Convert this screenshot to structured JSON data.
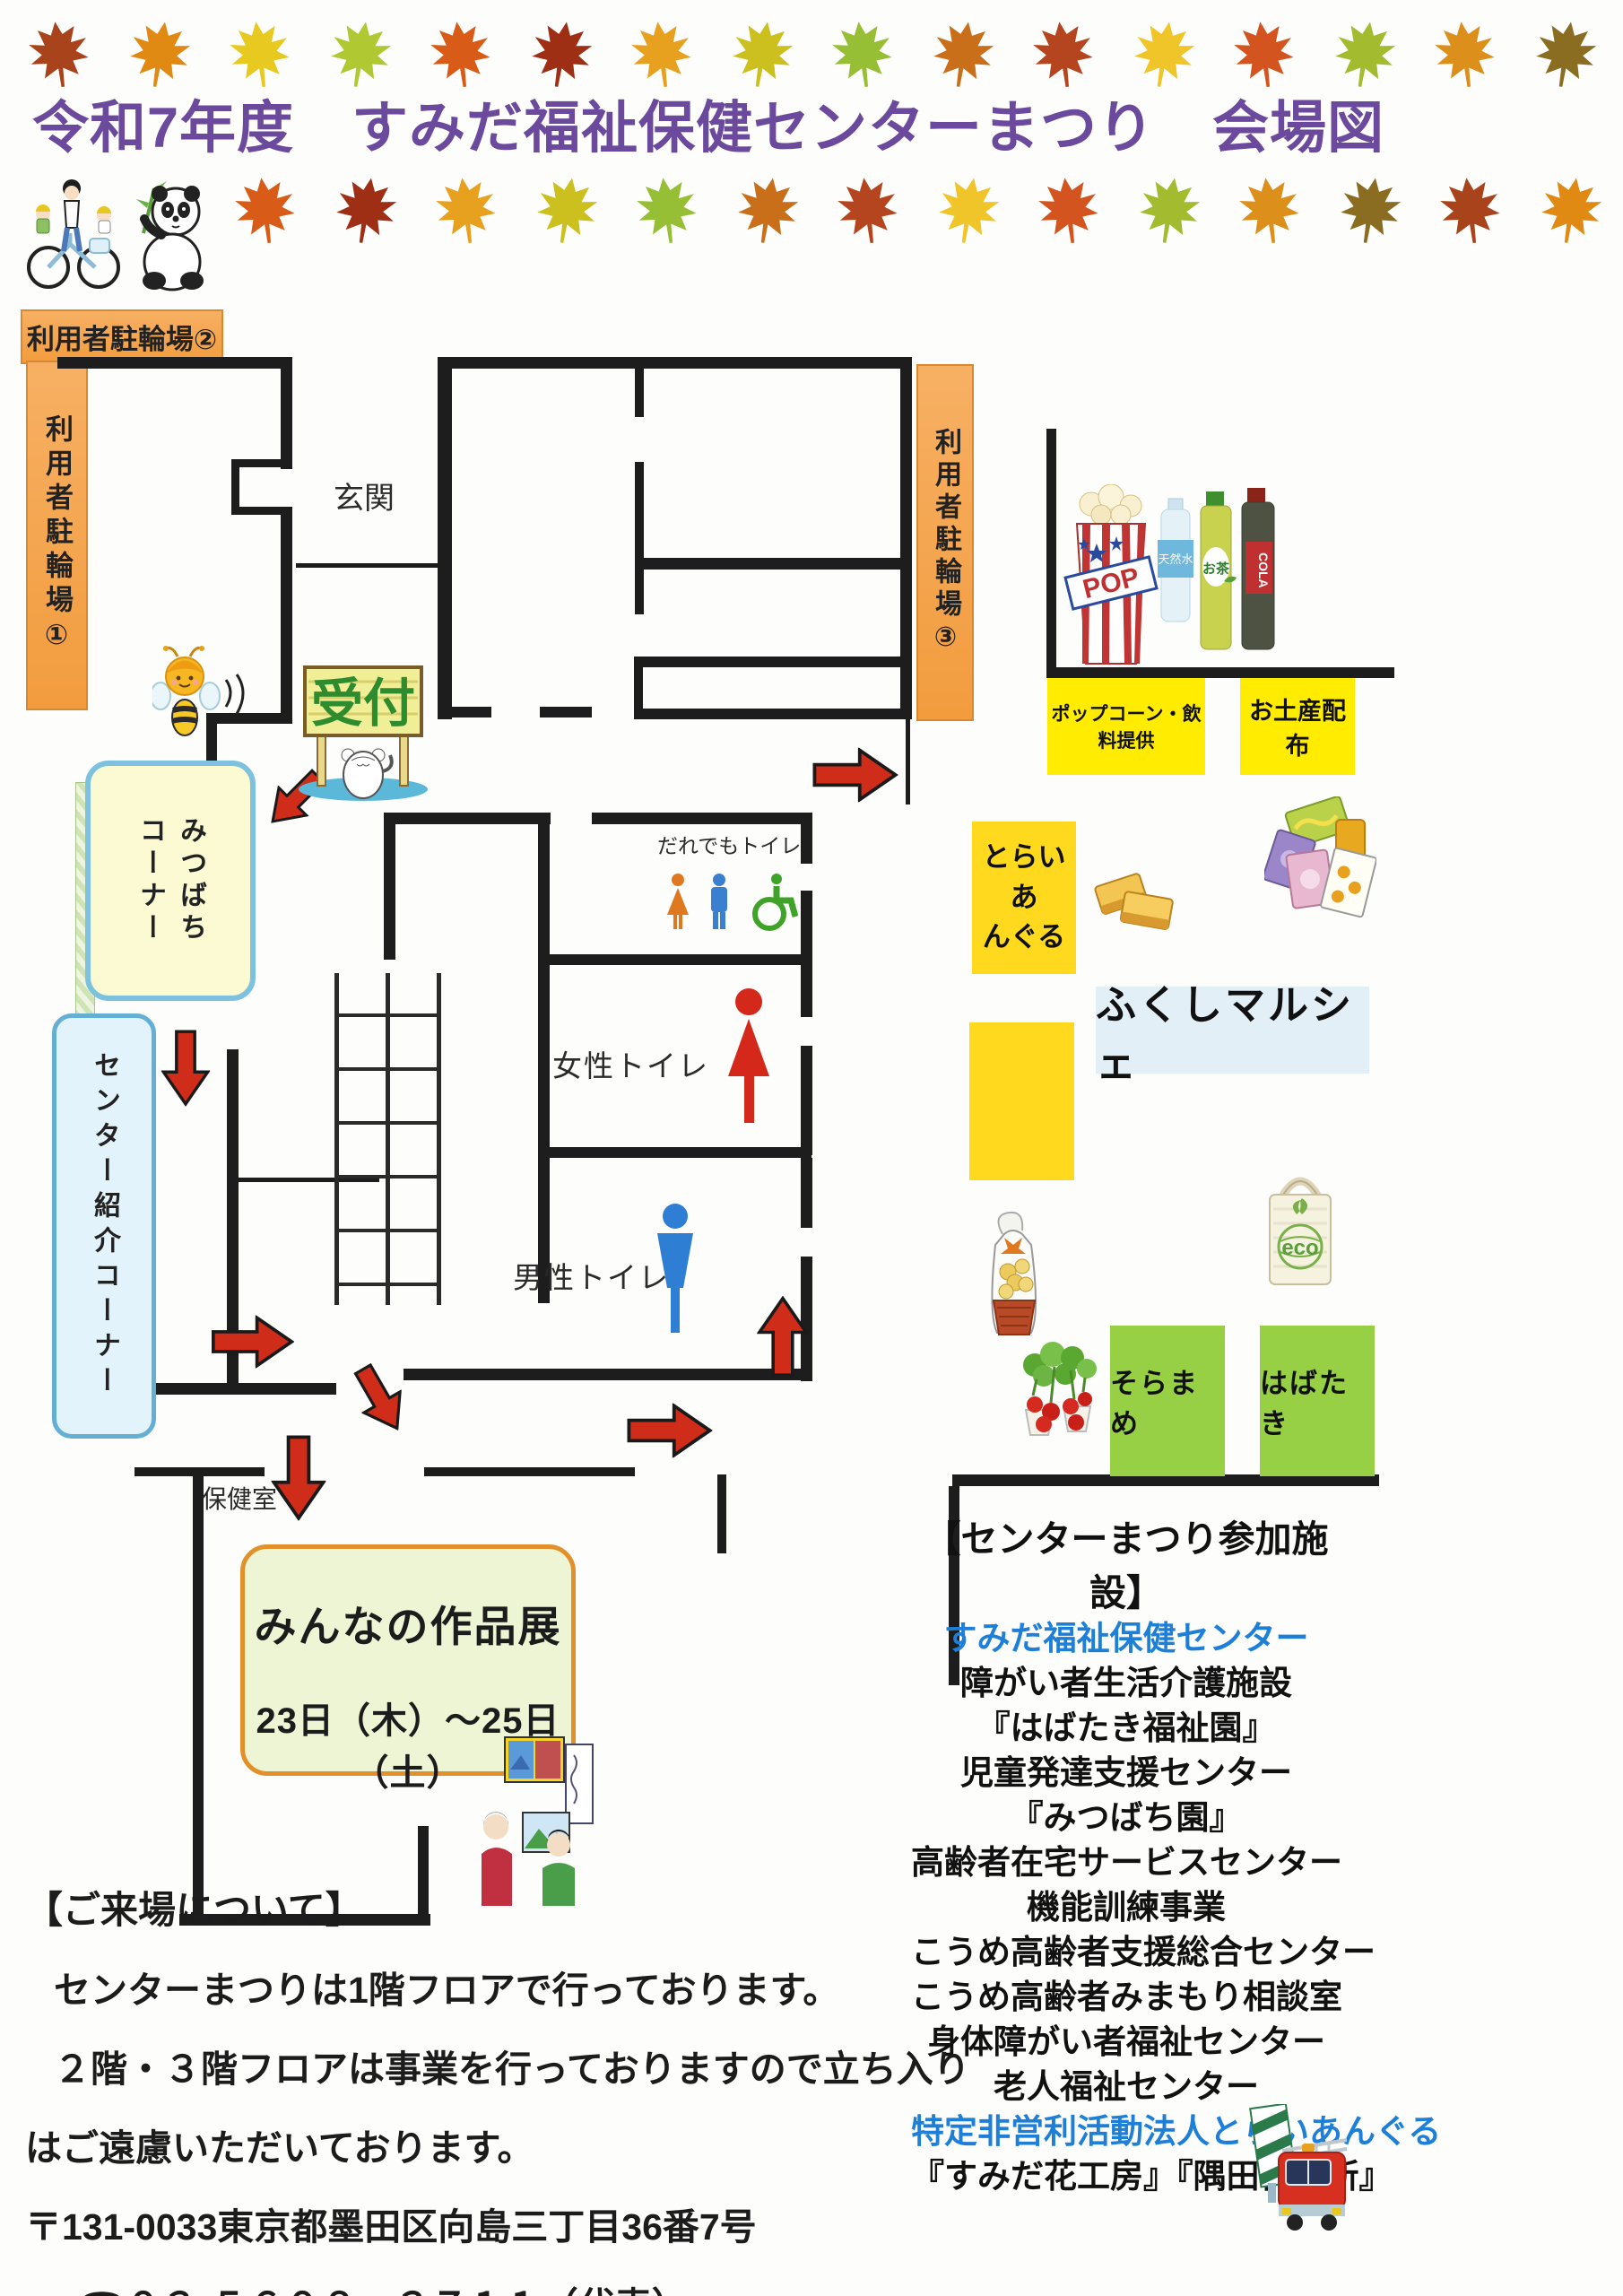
{
  "title": "令和7年度　すみだ福祉保健センターまつり　会場図",
  "map": {
    "parking1_label": "利用者駐輪場①",
    "parking2_label": "利用者駐輪場②",
    "parking3_label": "利用者駐輪場③",
    "entrance_label": "玄関",
    "reception_label": "受付",
    "health_room_label": "保健室",
    "mitsubachi_corner_label": "みつばち\nコーナー",
    "center_intro_label": "センター紹介コーナー",
    "anyone_toilet_label": "だれでもトイレ",
    "women_toilet_label": "女性トイレ",
    "men_toilet_label": "男性トイレ",
    "exhibition": {
      "title": "みんなの作品展",
      "dates": "23日（木）～25日（土）"
    },
    "popcorn_booth_label": "ポップコーン・飲料提供",
    "souvenir_booth_label": "お土産配布",
    "triangle_booth_label": "とらいあ\nんぐる",
    "marche_label": "ふくしマルシェ",
    "soramame_booth_label": "そらまめ",
    "habataki_booth_label": "はばたき"
  },
  "illustrations": {
    "popcorn_cup_label": "POP",
    "water_bottle_label": "天然水",
    "tea_bottle_label": "お茶",
    "cola_bottle_label": "COLA",
    "eco_bag_label": "eco"
  },
  "facilities": {
    "header": "【センターまつり参加施設】",
    "items": [
      {
        "text": "すみだ福祉保健センター",
        "highlight": true
      },
      {
        "text": "障がい者生活介護施設",
        "highlight": false
      },
      {
        "text": "『はばたき福祉園』",
        "highlight": false
      },
      {
        "text": "児童発達支援センター",
        "highlight": false
      },
      {
        "text": "『みつばち園』",
        "highlight": false
      },
      {
        "text": "高齢者在宅サービスセンター",
        "highlight": false
      },
      {
        "text": "機能訓練事業",
        "highlight": false
      },
      {
        "text": "こうめ高齢者支援総合センター",
        "highlight": false
      },
      {
        "text": "こうめ高齢者みまもり相談室",
        "highlight": false
      },
      {
        "text": "身体障がい者福祉センター",
        "highlight": false
      },
      {
        "text": "老人福祉センター",
        "highlight": false
      },
      {
        "text": "特定非営利活動法人とらいあんぐる",
        "highlight": true
      },
      {
        "text": "『すみだ花工房』『隅田作業所』",
        "highlight": false
      }
    ]
  },
  "visit_info": {
    "header": "【ご来場について】",
    "line1": "センターまつりは1階フロアで行っております。",
    "line2": "２階・３階フロアは事業を行っておりますので立ち入り",
    "line3": "はご遠慮いただいております。",
    "address": "〒131-0033東京都墨田区向島三丁目36番7号",
    "phone": "☎０３-５６０８－３７１１（代表）"
  },
  "colors": {
    "title_purple": "#6b4a9e",
    "highlight_blue": "#1e7fd8",
    "booth_yellow": "#ffec00",
    "booth_gold": "#ffd91e",
    "booth_green": "#97cf45",
    "parking_orange": "#f29c3e",
    "arrow_red": "#cf2c1a",
    "wall_black": "#1d1d1d"
  }
}
